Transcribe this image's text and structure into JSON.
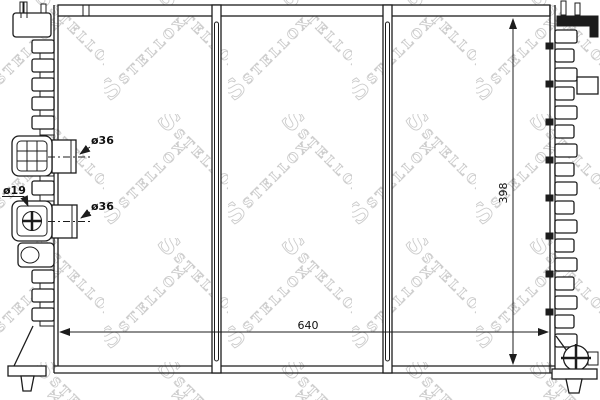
{
  "watermark": {
    "logo": "S",
    "text": "STELLOX"
  },
  "labels": {
    "port_upper_diameter": "ø36",
    "port_lower_diameter": "ø36",
    "drain_diameter": "ø19",
    "core_width": "640",
    "core_height": "398"
  },
  "colors": {
    "line": "#1c1c1c",
    "watermark": "#cccccc",
    "background": "#ffffff"
  }
}
